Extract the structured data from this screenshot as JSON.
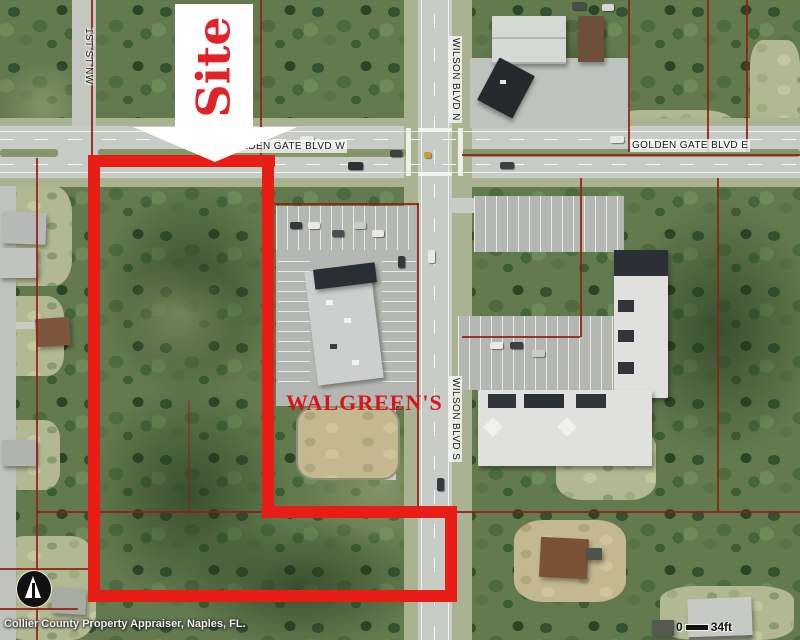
{
  "labels": {
    "first_st": "1ST ST NW",
    "golden_gate_w": "GOLDEN GATE BLVD W",
    "golden_gate_e": "GOLDEN GATE BLVD E",
    "wilson_n": "WILSON BLVD N",
    "wilson_s": "WILSON BLVD S"
  },
  "annotations": {
    "site": "Site",
    "walgreens": "WALGREEN'S"
  },
  "footer": {
    "attribution": "Collier County Property Appraiser, Naples, FL.",
    "scale_zero": "0",
    "scale_distance": "34ft"
  },
  "colors": {
    "site_boundary_red": "#e81d15",
    "parcel_line_red": "#8e2113",
    "site_text_red": "#e02327",
    "walgreens_text_red": "#d6161a"
  },
  "icons": {
    "north_arrow": "north-arrow-icon",
    "site_arrow": "site-down-arrow-icon"
  }
}
